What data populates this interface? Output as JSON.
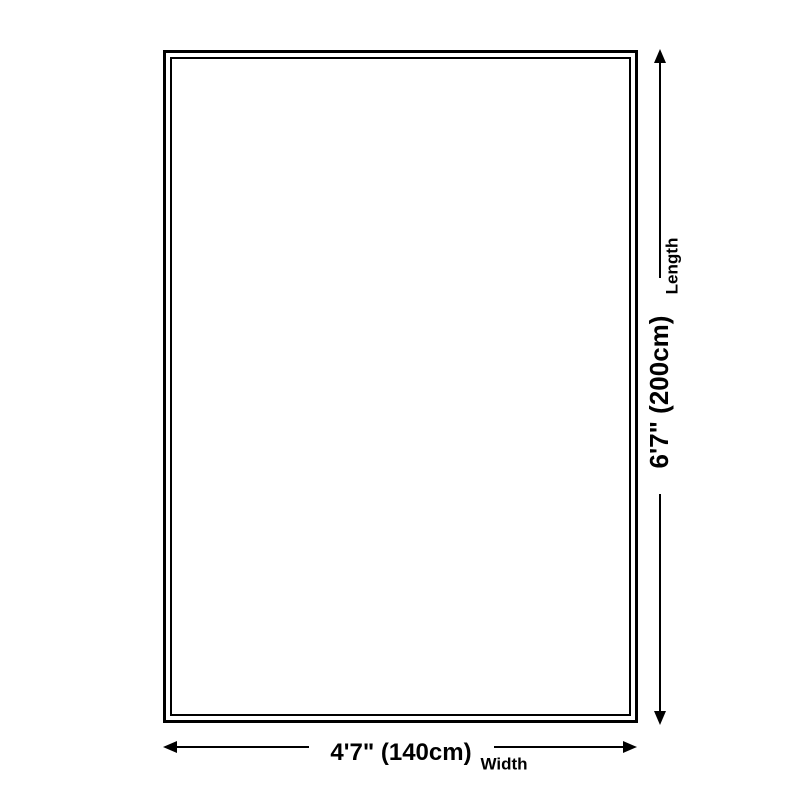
{
  "diagram": {
    "type": "product-dimension-diagram",
    "length_label": "6'7\" (200cm)",
    "length_caption": "Length",
    "width_label": "4'7\" (140cm)",
    "width_caption": "Width"
  },
  "icons": {
    "arrow_up": "css-triangle-up",
    "arrow_down": "css-triangle-down",
    "arrow_left": "css-triangle-left",
    "arrow_right": "css-triangle-right"
  },
  "colors": {
    "line": "#000000",
    "text": "#000000",
    "background": "#ffffff"
  }
}
